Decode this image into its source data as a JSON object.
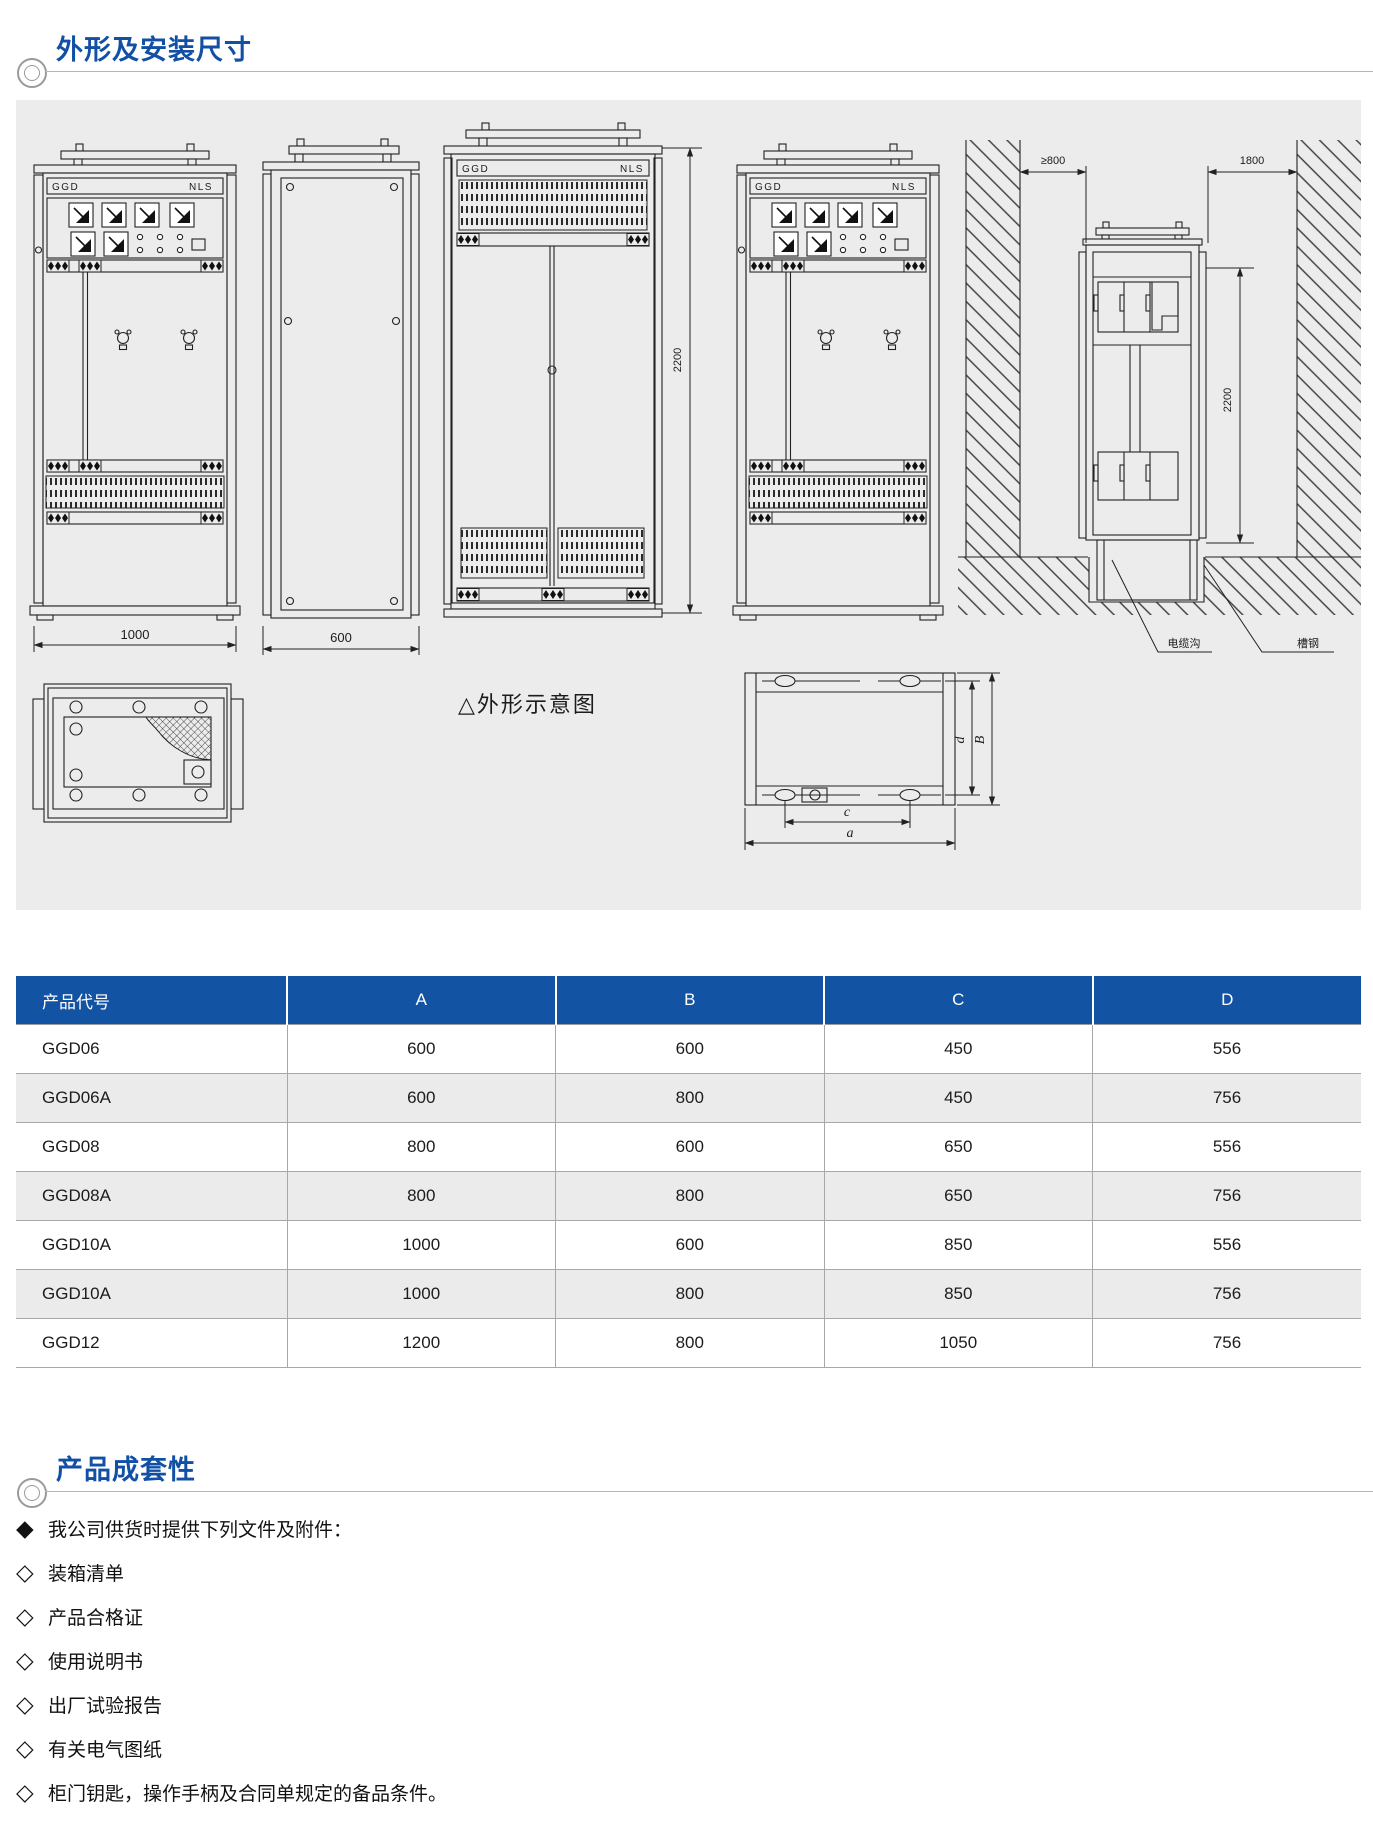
{
  "colors": {
    "accent_blue": "#1253a3",
    "title_blue": "#1150a5",
    "panel_bg": "#ececec",
    "row_alt": "#ebebeb"
  },
  "sections": {
    "dimensions": {
      "title": "外形及安装尺寸"
    },
    "completeness": {
      "title": "产品成套性"
    }
  },
  "drawings": {
    "cabinet_label_left": "GGD",
    "cabinet_label_right": "NLS",
    "dim_width_front": "1000",
    "dim_width_side": "600",
    "dim_height_rear": "2200",
    "install": {
      "clearance_left": "≥800",
      "clearance_right": "1800",
      "height": "2200",
      "label_cable_trench": "电缆沟",
      "label_channel_steel": "槽钢"
    },
    "caption": "△外形示意图",
    "plan": {
      "dim_a": "a",
      "dim_b": "B",
      "dim_c": "c",
      "dim_d": "d"
    }
  },
  "table": {
    "columns": [
      "产品代号",
      "A",
      "B",
      "C",
      "D"
    ],
    "rows": [
      [
        "GGD06",
        "600",
        "600",
        "450",
        "556"
      ],
      [
        "GGD06A",
        "600",
        "800",
        "450",
        "756"
      ],
      [
        "GGD08",
        "800",
        "600",
        "650",
        "556"
      ],
      [
        "GGD08A",
        "800",
        "800",
        "650",
        "756"
      ],
      [
        "GGD10A",
        "1000",
        "600",
        "850",
        "556"
      ],
      [
        "GGD10A",
        "1000",
        "800",
        "850",
        "756"
      ],
      [
        "GGD12",
        "1200",
        "800",
        "1050",
        "756"
      ]
    ]
  },
  "list": {
    "items": [
      {
        "bullet": "◆",
        "text": "我公司供货时提供下列文件及附件："
      },
      {
        "bullet": "◇",
        "text": "装箱清单"
      },
      {
        "bullet": "◇",
        "text": "产品合格证"
      },
      {
        "bullet": "◇",
        "text": "使用说明书"
      },
      {
        "bullet": "◇",
        "text": "出厂试验报告"
      },
      {
        "bullet": "◇",
        "text": "有关电气图纸"
      },
      {
        "bullet": "◇",
        "text": "柜门钥匙，操作手柄及合同单规定的备品条件。"
      }
    ]
  }
}
